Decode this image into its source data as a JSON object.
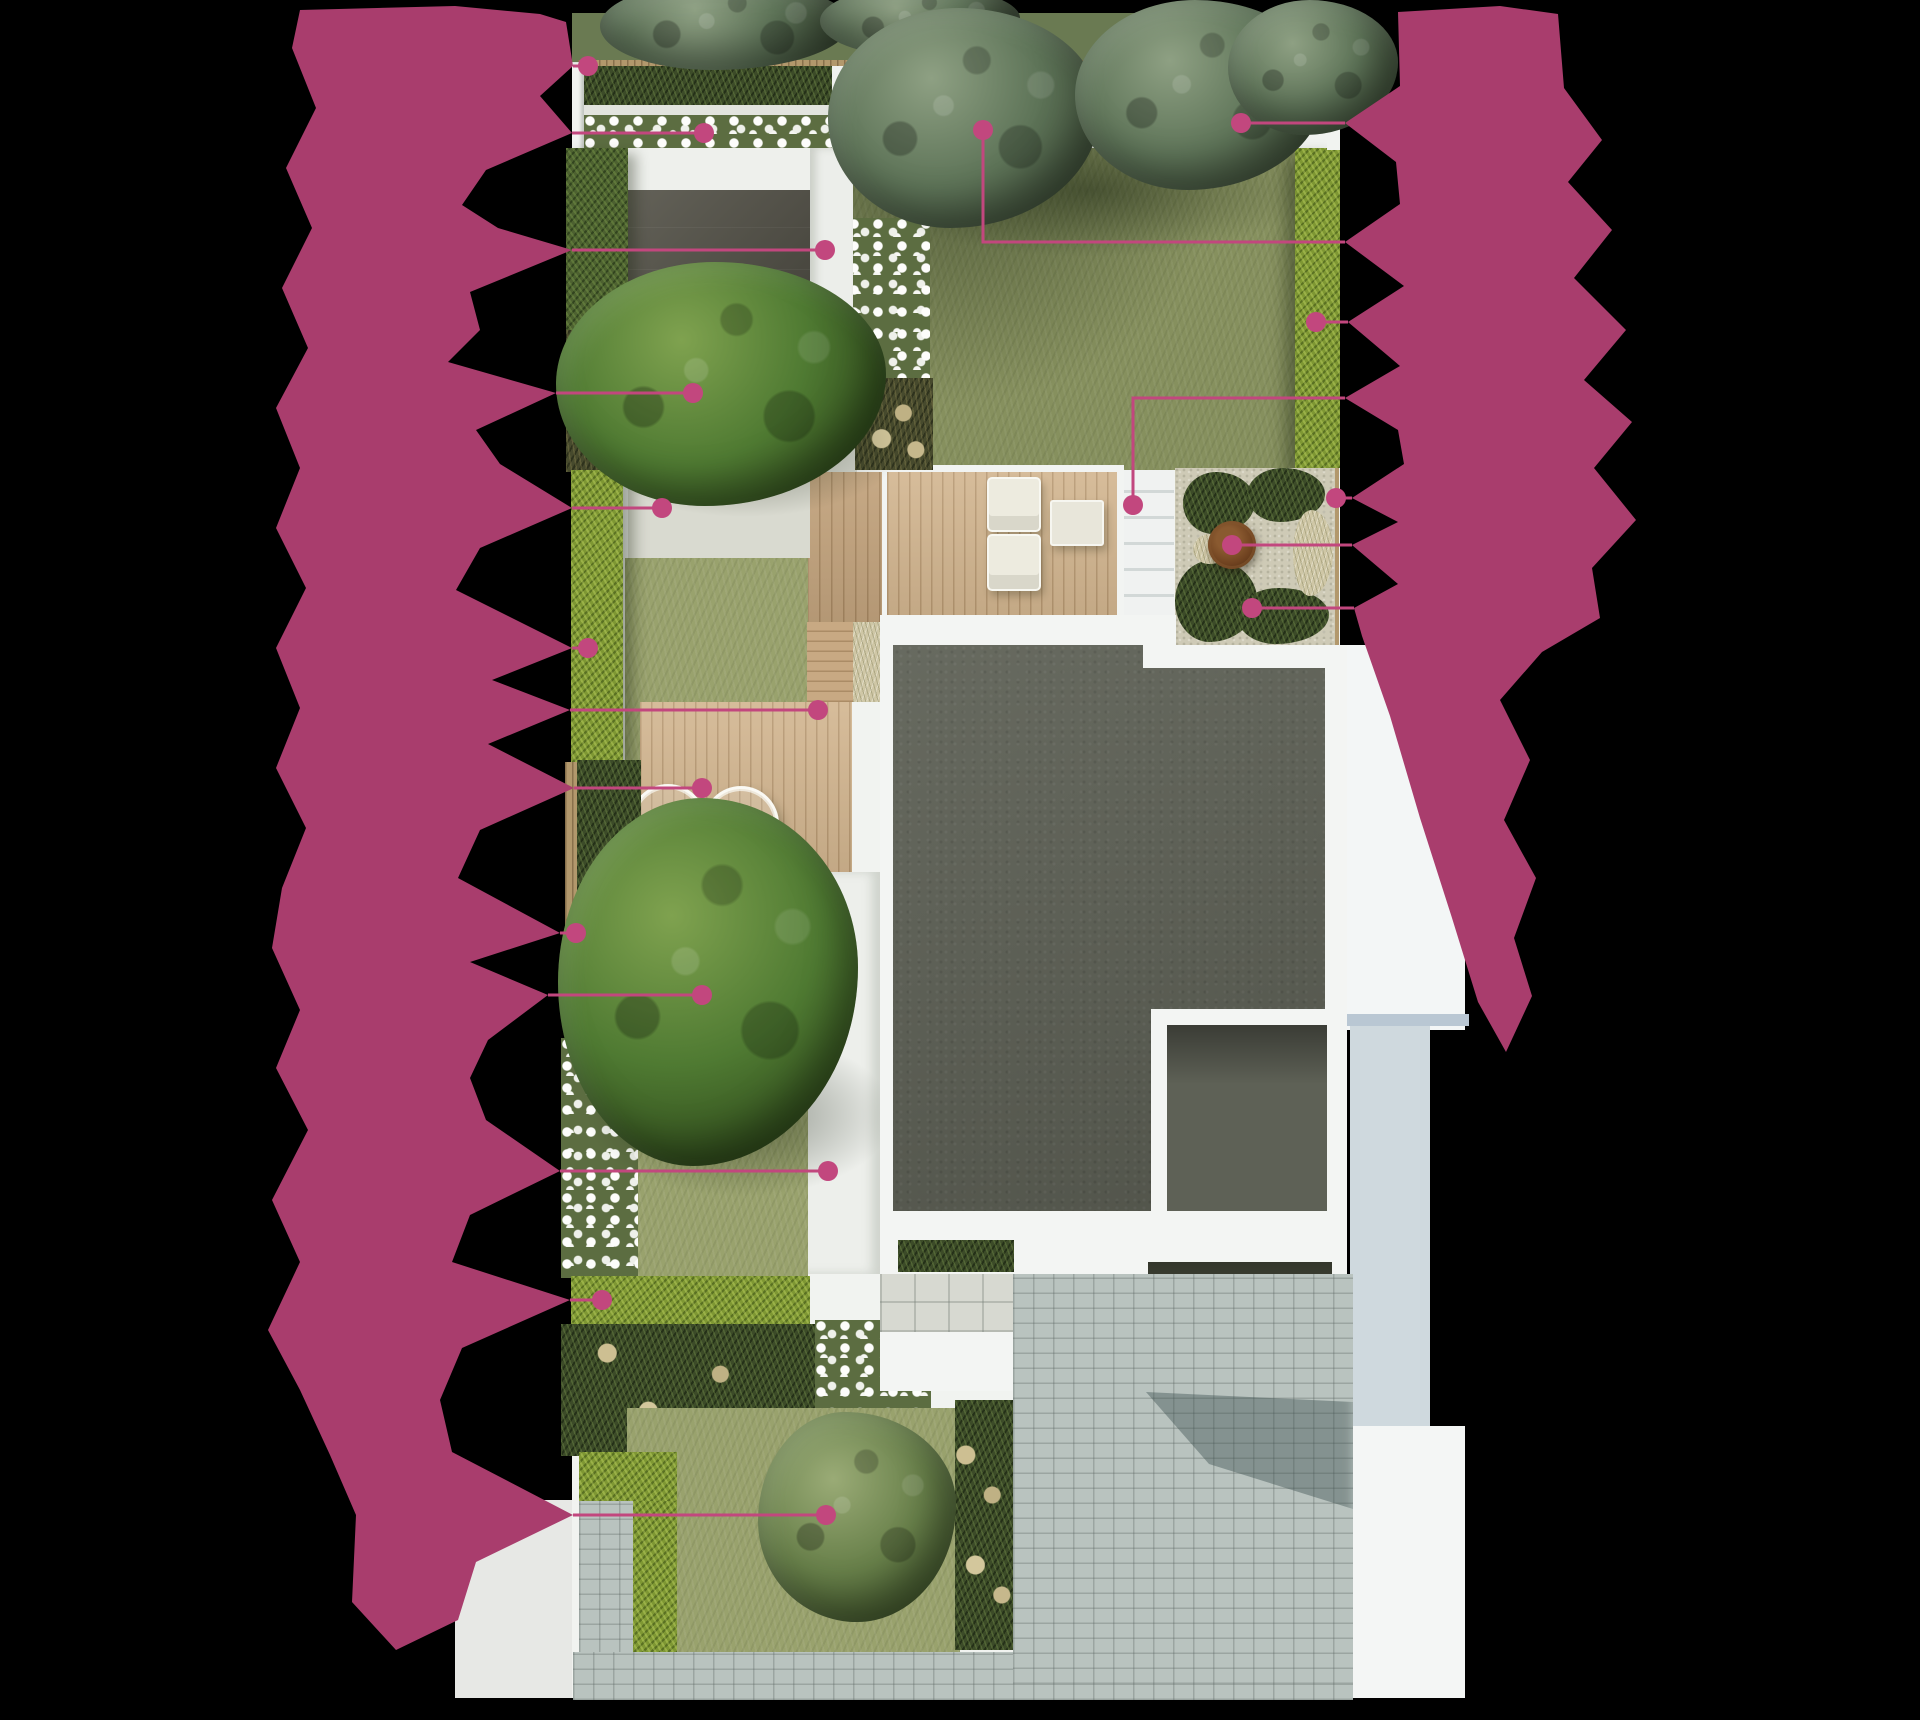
{
  "page": {
    "title": "Annotated garden landscape plan (top view render)",
    "canvas": {
      "width": 1920,
      "height": 1720
    },
    "background": "#000000",
    "labels_obscured": true
  },
  "palette": {
    "blob": "#a93d6d",
    "leader": "#c2477e",
    "lawn": "#8e9766",
    "hedge_bright": "#7e9733",
    "hedge_dark": "#4d6130",
    "deck_wood": "#d2b58f",
    "roof": "#5e6156",
    "paving": "#b9c3bf",
    "white_wall": "#f1f3f0",
    "fire_bowl": "#6e411f",
    "fence": "#b2986c"
  },
  "annotations": {
    "left": [
      {
        "id": "l1",
        "target": "top-boundary-fence",
        "marker": {
          "x": 588,
          "y": 66
        },
        "points": [
          [
            573,
            66
          ],
          [
            588,
            66
          ]
        ]
      },
      {
        "id": "l2",
        "target": "top-flower-bed",
        "marker": {
          "x": 704,
          "y": 133
        },
        "points": [
          [
            572,
            133
          ],
          [
            704,
            133
          ]
        ]
      },
      {
        "id": "l3",
        "target": "side-path",
        "marker": {
          "x": 825,
          "y": 250
        },
        "points": [
          [
            572,
            250
          ],
          [
            825,
            250
          ]
        ]
      },
      {
        "id": "l4",
        "target": "specimen-tree-north",
        "marker": {
          "x": 693,
          "y": 393
        },
        "points": [
          [
            556,
            393
          ],
          [
            693,
            393
          ]
        ]
      },
      {
        "id": "l5",
        "target": "stone-terrace",
        "marker": {
          "x": 662,
          "y": 508
        },
        "points": [
          [
            572,
            508
          ],
          [
            662,
            508
          ]
        ]
      },
      {
        "id": "l6",
        "target": "side-hedge",
        "marker": {
          "x": 588,
          "y": 648
        },
        "points": [
          [
            572,
            648
          ],
          [
            588,
            648
          ]
        ]
      },
      {
        "id": "l7",
        "target": "deck-walkway",
        "marker": {
          "x": 818,
          "y": 710
        },
        "points": [
          [
            570,
            710
          ],
          [
            818,
            710
          ]
        ]
      },
      {
        "id": "l8",
        "target": "dining-deck",
        "marker": {
          "x": 702,
          "y": 788
        },
        "points": [
          [
            574,
            788
          ],
          [
            702,
            788
          ]
        ]
      },
      {
        "id": "l9",
        "target": "boundary-fence-left",
        "marker": {
          "x": 576,
          "y": 933
        },
        "points": [
          [
            560,
            933
          ],
          [
            576,
            933
          ]
        ]
      },
      {
        "id": "l10",
        "target": "specimen-tree-middle",
        "marker": {
          "x": 702,
          "y": 995
        },
        "points": [
          [
            548,
            995
          ],
          [
            702,
            995
          ]
        ]
      },
      {
        "id": "l11",
        "target": "garden-path",
        "marker": {
          "x": 828,
          "y": 1171
        },
        "points": [
          [
            560,
            1171
          ],
          [
            828,
            1171
          ]
        ]
      },
      {
        "id": "l12",
        "target": "front-hedge",
        "marker": {
          "x": 602,
          "y": 1300
        },
        "points": [
          [
            570,
            1300
          ],
          [
            602,
            1300
          ]
        ]
      },
      {
        "id": "l13",
        "target": "front-shrub",
        "marker": {
          "x": 826,
          "y": 1515
        },
        "points": [
          [
            573,
            1515
          ],
          [
            826,
            1515
          ]
        ]
      }
    ],
    "right": [
      {
        "id": "r1",
        "target": "canopy-tree-back",
        "marker": {
          "x": 1241,
          "y": 123
        },
        "points": [
          [
            1241,
            123
          ],
          [
            1345,
            123
          ]
        ]
      },
      {
        "id": "r2",
        "target": "garden-gate",
        "marker": {
          "x": 983,
          "y": 130
        },
        "points": [
          [
            983,
            130
          ],
          [
            983,
            242
          ],
          [
            1345,
            242
          ]
        ]
      },
      {
        "id": "r3",
        "target": "back-hedge",
        "marker": {
          "x": 1316,
          "y": 322
        },
        "points": [
          [
            1316,
            322
          ],
          [
            1348,
            322
          ]
        ]
      },
      {
        "id": "r4",
        "target": "house-steps",
        "marker": {
          "x": 1133,
          "y": 505
        },
        "points": [
          [
            1133,
            505
          ],
          [
            1133,
            398
          ],
          [
            1345,
            398
          ]
        ]
      },
      {
        "id": "r5",
        "target": "boundary-fence-right",
        "marker": {
          "x": 1336,
          "y": 498
        },
        "points": [
          [
            1336,
            498
          ],
          [
            1352,
            498
          ]
        ]
      },
      {
        "id": "r6",
        "target": "fire-bowl",
        "marker": {
          "x": 1232,
          "y": 545
        },
        "points": [
          [
            1232,
            545
          ],
          [
            1352,
            545
          ]
        ]
      },
      {
        "id": "r7",
        "target": "gravel-planting",
        "marker": {
          "x": 1252,
          "y": 608
        },
        "points": [
          [
            1252,
            608
          ],
          [
            1354,
            608
          ]
        ]
      }
    ]
  }
}
